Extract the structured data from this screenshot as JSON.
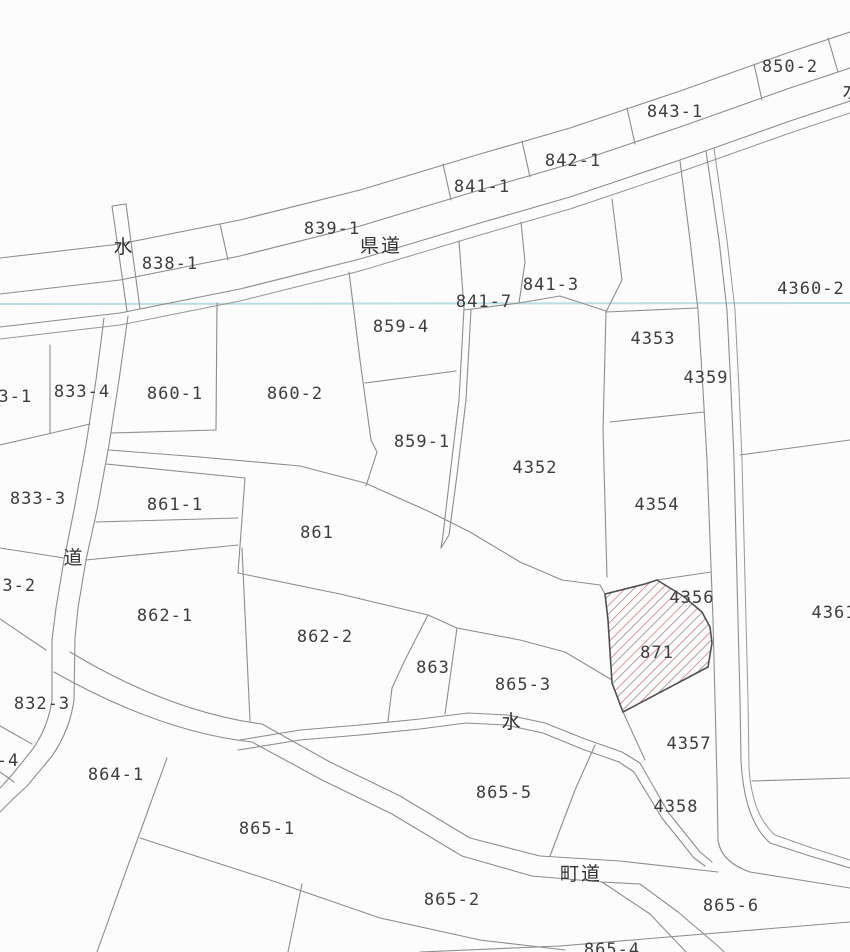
{
  "map": {
    "kind": "japanese-cadastral-map",
    "colors": {
      "background": "#fcfcfc",
      "boundary_line": "#8d8d8d",
      "highlight_outline": "#4f4f4f",
      "hatch_red": "#c05a6a",
      "hatch_gray": "#ada0a0",
      "water_line_cyan": "#b5dbde",
      "label_text": "#3d3d3d"
    },
    "highlighted_parcel": {
      "number": "871",
      "style": "red-diagonal-hatch"
    },
    "labels": [
      {
        "name": "label-850-2",
        "text": "850-2",
        "x": 790,
        "y": 72,
        "kind": "parcel"
      },
      {
        "name": "label-843-1",
        "text": "843-1",
        "x": 675,
        "y": 117,
        "kind": "parcel"
      },
      {
        "name": "label-842-1",
        "text": "842-1",
        "x": 573,
        "y": 166,
        "kind": "parcel"
      },
      {
        "name": "label-841-1",
        "text": "841-1",
        "x": 482,
        "y": 192,
        "kind": "parcel"
      },
      {
        "name": "label-839-1",
        "text": "839-1",
        "x": 332,
        "y": 234,
        "kind": "parcel"
      },
      {
        "name": "label-838-1",
        "text": "838-1",
        "x": 170,
        "y": 269,
        "kind": "parcel"
      },
      {
        "name": "label-water-strip",
        "text": "水",
        "x": 124,
        "y": 253,
        "kind": "water"
      },
      {
        "name": "label-kendo",
        "text": "県道",
        "x": 381,
        "y": 252,
        "kind": "road"
      },
      {
        "name": "label-841-7",
        "text": "841-7",
        "x": 484,
        "y": 307,
        "kind": "parcel"
      },
      {
        "name": "label-841-3",
        "text": "841-3",
        "x": 551,
        "y": 290,
        "kind": "parcel"
      },
      {
        "name": "label-4360-2",
        "text": "4360-2",
        "x": 811,
        "y": 294,
        "kind": "parcel"
      },
      {
        "name": "label-859-4",
        "text": "859-4",
        "x": 401,
        "y": 332,
        "kind": "parcel"
      },
      {
        "name": "label-4353",
        "text": "4353",
        "x": 653,
        "y": 344,
        "kind": "parcel"
      },
      {
        "name": "label-4359",
        "text": "4359",
        "x": 706,
        "y": 383,
        "kind": "parcel"
      },
      {
        "name": "label-833-4",
        "text": "833-4",
        "x": 82,
        "y": 397,
        "kind": "parcel"
      },
      {
        "name": "label-833-1",
        "text": "833-1",
        "x": 4,
        "y": 402,
        "kind": "parcel"
      },
      {
        "name": "label-860-1",
        "text": "860-1",
        "x": 175,
        "y": 399,
        "kind": "parcel"
      },
      {
        "name": "label-860-2",
        "text": "860-2",
        "x": 295,
        "y": 399,
        "kind": "parcel"
      },
      {
        "name": "label-859-1",
        "text": "859-1",
        "x": 422,
        "y": 447,
        "kind": "parcel"
      },
      {
        "name": "label-4352",
        "text": "4352",
        "x": 535,
        "y": 473,
        "kind": "parcel"
      },
      {
        "name": "label-833-3",
        "text": "833-3",
        "x": 38,
        "y": 504,
        "kind": "parcel"
      },
      {
        "name": "label-861-1",
        "text": "861-1",
        "x": 175,
        "y": 510,
        "kind": "parcel"
      },
      {
        "name": "label-861",
        "text": "861",
        "x": 317,
        "y": 538,
        "kind": "parcel"
      },
      {
        "name": "label-michi",
        "text": "道",
        "x": 74,
        "y": 564,
        "kind": "road"
      },
      {
        "name": "label-833-2",
        "text": "833-2",
        "x": 8,
        "y": 591,
        "kind": "parcel"
      },
      {
        "name": "label-862-1",
        "text": "862-1",
        "x": 165,
        "y": 621,
        "kind": "parcel"
      },
      {
        "name": "label-862-2",
        "text": "862-2",
        "x": 325,
        "y": 642,
        "kind": "parcel"
      },
      {
        "name": "label-863",
        "text": "863",
        "x": 433,
        "y": 673,
        "kind": "parcel"
      },
      {
        "name": "label-865-3",
        "text": "865-3",
        "x": 523,
        "y": 690,
        "kind": "parcel"
      },
      {
        "name": "label-4354",
        "text": "4354",
        "x": 657,
        "y": 510,
        "kind": "parcel"
      },
      {
        "name": "label-4356",
        "text": "4356",
        "x": 692,
        "y": 603,
        "kind": "parcel"
      },
      {
        "name": "label-871",
        "text": "871",
        "x": 657,
        "y": 658,
        "kind": "parcel"
      },
      {
        "name": "label-4361",
        "text": "4361",
        "x": 834,
        "y": 618,
        "kind": "parcel"
      },
      {
        "name": "label-water-channel",
        "text": "水",
        "x": 512,
        "y": 728,
        "kind": "water"
      },
      {
        "name": "label-832-3",
        "text": "832-3",
        "x": 42,
        "y": 709,
        "kind": "parcel"
      },
      {
        "name": "label-832-4",
        "text": "-4",
        "x": 8,
        "y": 766,
        "kind": "parcel"
      },
      {
        "name": "label-864-1",
        "text": "864-1",
        "x": 116,
        "y": 780,
        "kind": "parcel"
      },
      {
        "name": "label-865-5",
        "text": "865-5",
        "x": 504,
        "y": 798,
        "kind": "parcel"
      },
      {
        "name": "label-4357",
        "text": "4357",
        "x": 689,
        "y": 749,
        "kind": "parcel"
      },
      {
        "name": "label-4358",
        "text": "4358",
        "x": 676,
        "y": 812,
        "kind": "parcel"
      },
      {
        "name": "label-865-1",
        "text": "865-1",
        "x": 267,
        "y": 834,
        "kind": "parcel"
      },
      {
        "name": "label-chodo",
        "text": "町道",
        "x": 581,
        "y": 880,
        "kind": "road"
      },
      {
        "name": "label-865-2",
        "text": "865-2",
        "x": 452,
        "y": 905,
        "kind": "parcel"
      },
      {
        "name": "label-865-6",
        "text": "865-6",
        "x": 731,
        "y": 911,
        "kind": "parcel"
      },
      {
        "name": "label-865-4",
        "text": "865-4",
        "x": 612,
        "y": 955,
        "kind": "parcel"
      },
      {
        "name": "label-water-corner",
        "text": "水",
        "x": 853,
        "y": 97,
        "kind": "water"
      }
    ]
  }
}
